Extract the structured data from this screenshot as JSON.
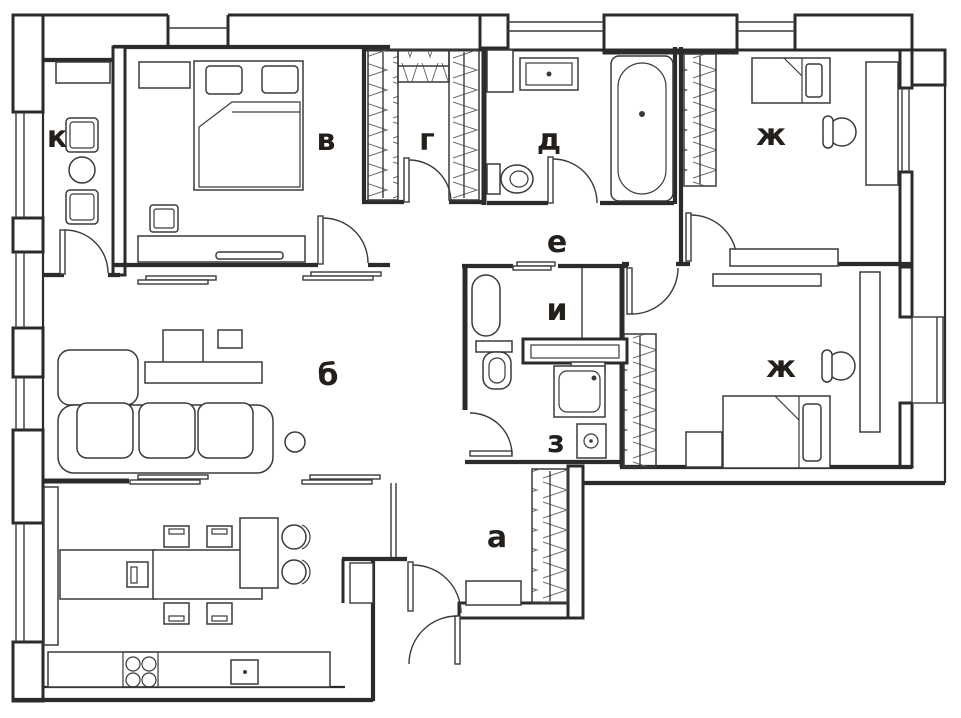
{
  "document": {
    "type": "apartment-floor-plan",
    "description": "Black and white architectural floor plan with Cyrillic room letters"
  },
  "colors": {
    "wall": "#2b2b2b",
    "furniture_line": "#3a3a3a",
    "hanger_line": "#6e6e6e",
    "label": "#241f1b",
    "background": "#ffffff"
  },
  "rooms": [
    {
      "id": "room-k",
      "label": "к"
    },
    {
      "id": "room-v",
      "label": "в"
    },
    {
      "id": "room-g",
      "label": "г"
    },
    {
      "id": "room-d",
      "label": "д"
    },
    {
      "id": "room-zh1",
      "label": "ж"
    },
    {
      "id": "room-e",
      "label": "е"
    },
    {
      "id": "room-i",
      "label": "и"
    },
    {
      "id": "room-b",
      "label": "б"
    },
    {
      "id": "room-z",
      "label": "з"
    },
    {
      "id": "room-zh2",
      "label": "ж"
    },
    {
      "id": "room-a",
      "label": "а"
    }
  ]
}
